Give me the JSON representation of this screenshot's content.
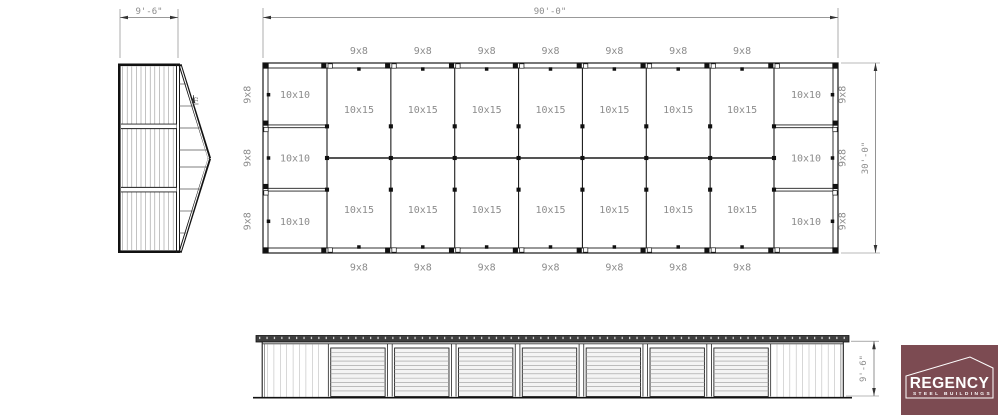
{
  "plan": {
    "overall_width": "90'-0\"",
    "overall_depth": "30'-0\"",
    "top_doors": [
      "9x8",
      "9x8",
      "9x8",
      "9x8",
      "9x8",
      "9x8",
      "9x8"
    ],
    "bottom_doors": [
      "9x8",
      "9x8",
      "9x8",
      "9x8",
      "9x8",
      "9x8",
      "9x8"
    ],
    "left_doors": [
      "9x8",
      "9x8",
      "9x8"
    ],
    "right_doors": [
      "9x8",
      "9x8",
      "9x8"
    ],
    "left_units": [
      "10x10",
      "10x10",
      "10x10"
    ],
    "right_units": [
      "10x10",
      "10x10",
      "10x10"
    ],
    "top_units": [
      "10x15",
      "10x15",
      "10x15",
      "10x15",
      "10x15",
      "10x15",
      "10x15"
    ],
    "bottom_units": [
      "10x15",
      "10x15",
      "10x15",
      "10x15",
      "10x15",
      "10x15",
      "10x15"
    ]
  },
  "end_elevation": {
    "width_dim": "9'-6\"",
    "pitch_label": "12"
  },
  "side_elevation": {
    "height_dim": "9'-6\""
  },
  "logo": {
    "brand": "REGENCY",
    "tagline": "STEEL BUILDINGS",
    "bg_color": "#7c4b52",
    "text_color": "#ffffff"
  },
  "colors": {
    "line": "#1c1c1c",
    "thin": "#777777",
    "label": "#8c8c8c",
    "stripe": "#909090",
    "roof_band": "#3f3f3f"
  }
}
